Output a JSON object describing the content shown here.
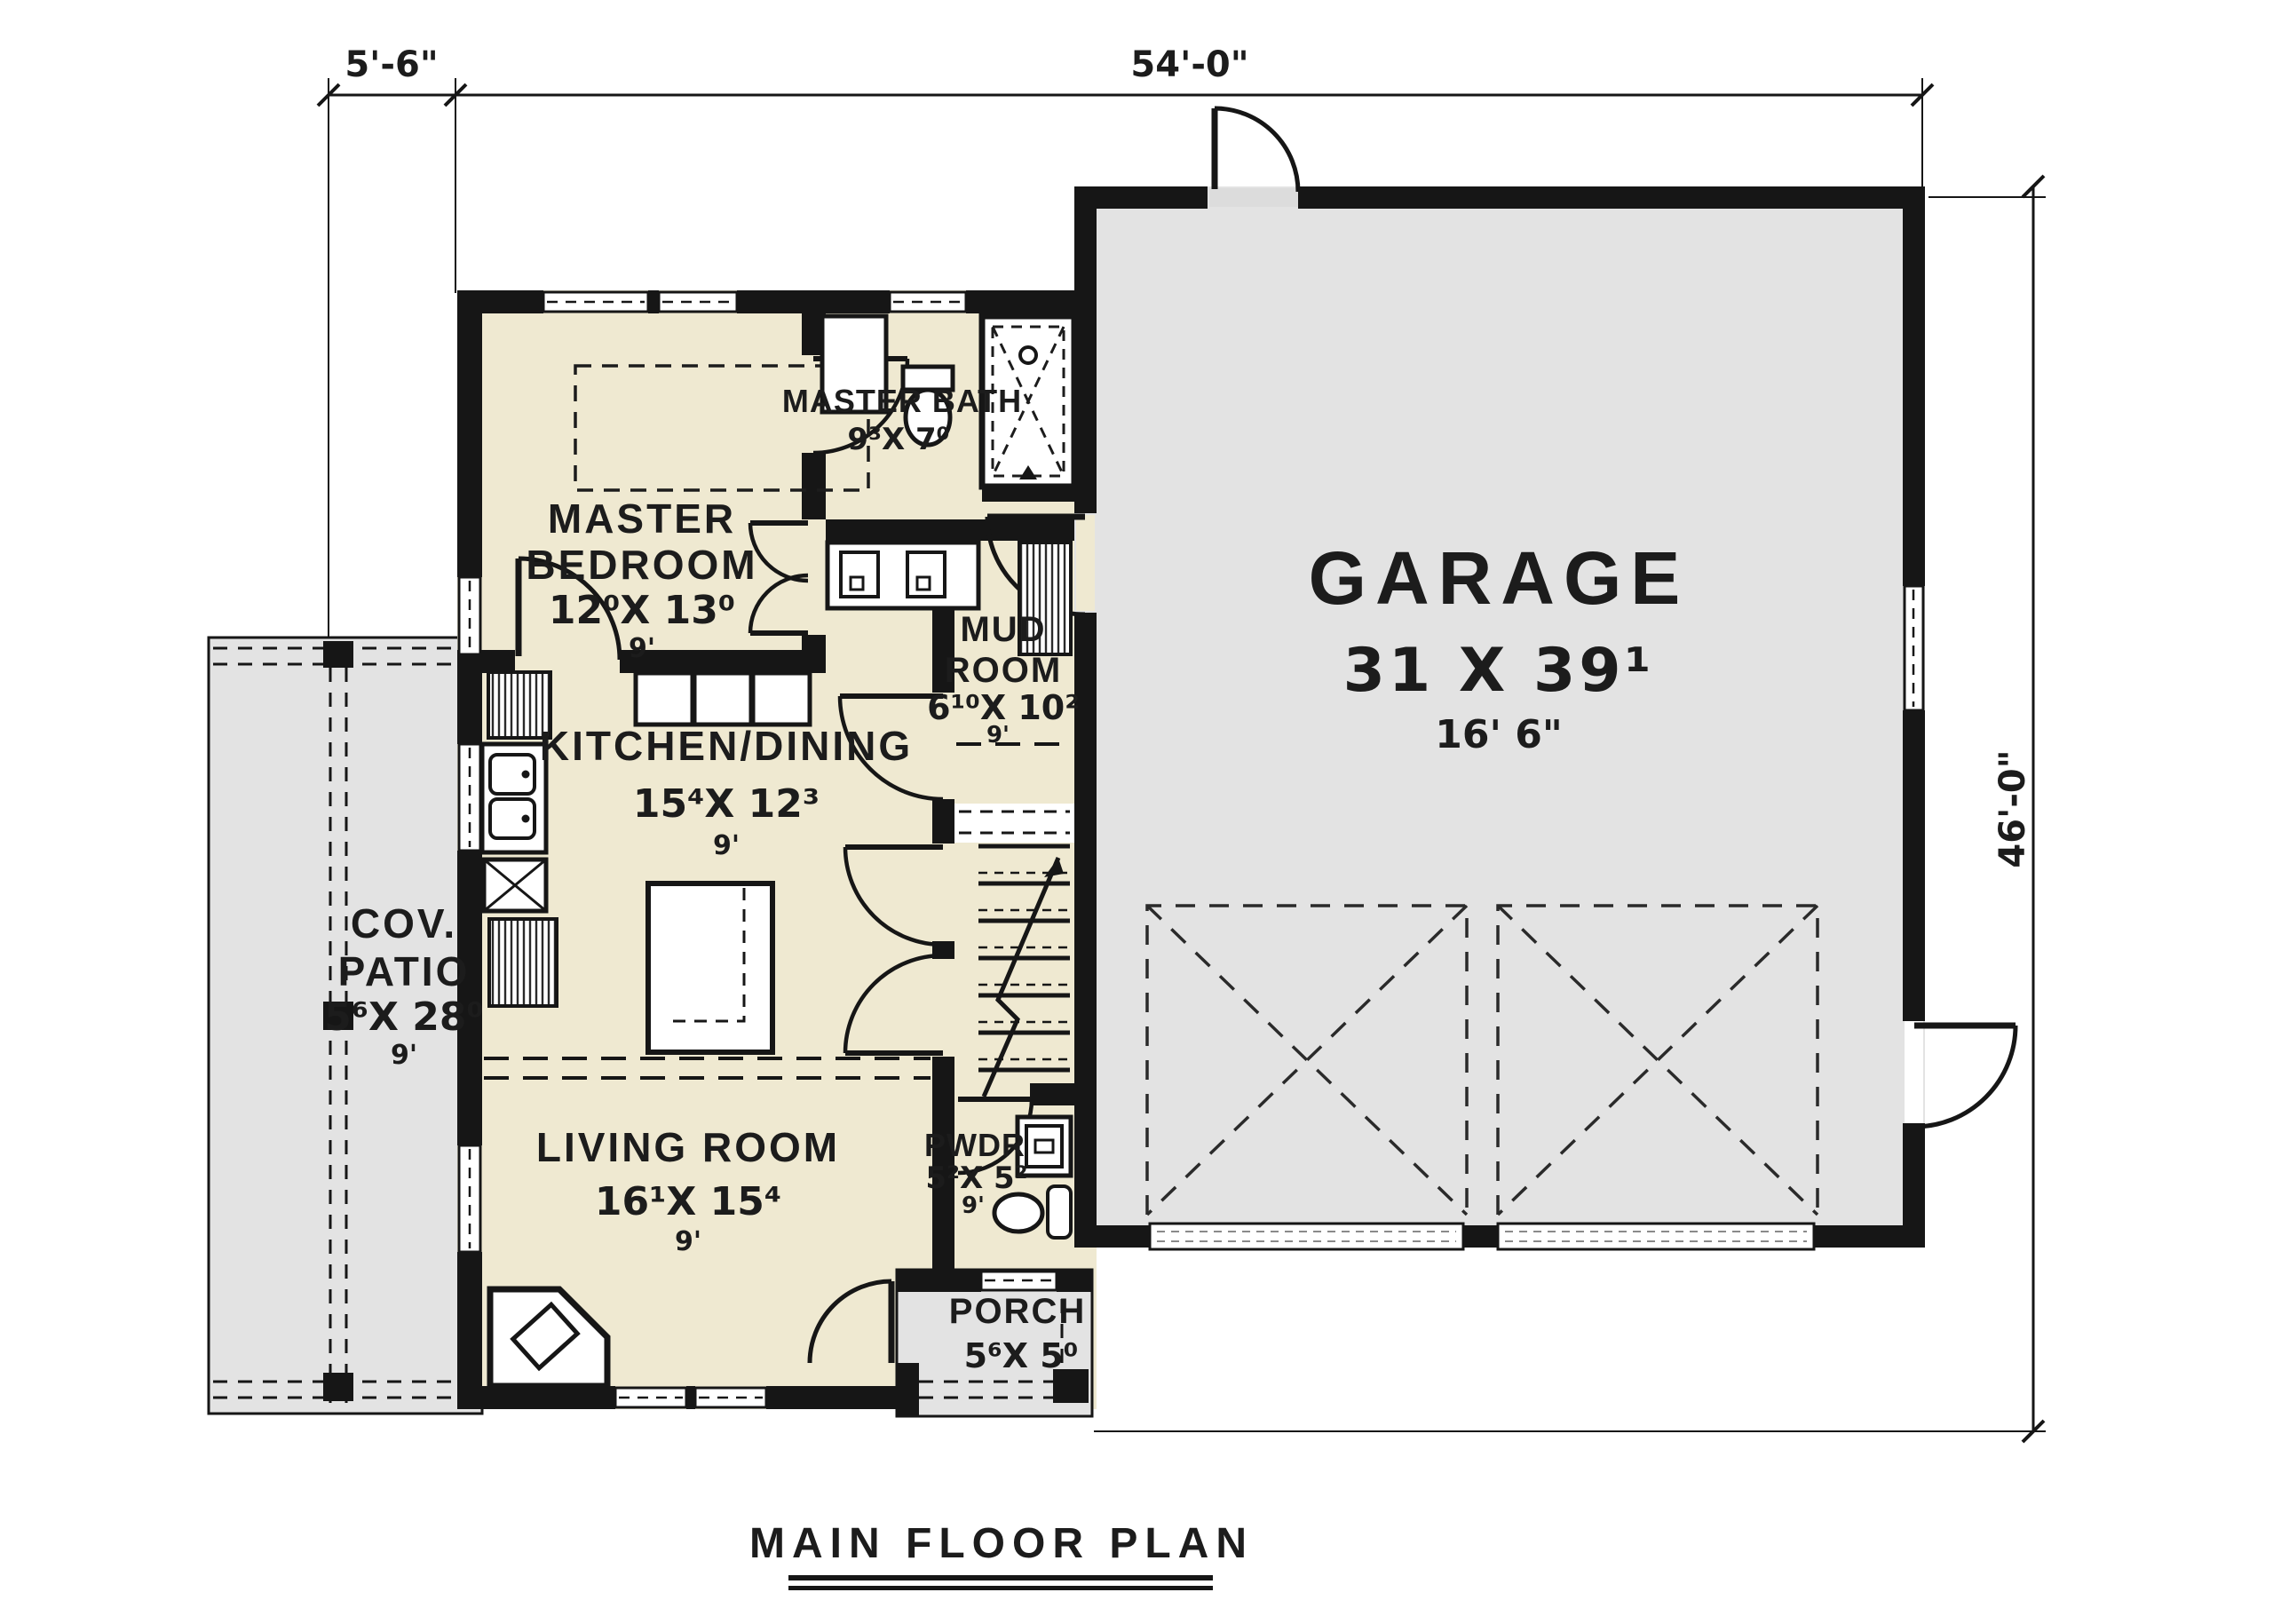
{
  "page_title": "MAIN FLOOR PLAN",
  "dimensions": {
    "left_offset": "5'-6\"",
    "overall_width": "54'-0\"",
    "overall_height": "46'-0\""
  },
  "rooms": {
    "garage": {
      "name": "GARAGE",
      "size": "31 X 39¹",
      "clg": "16' 6\""
    },
    "master_bedroom": {
      "name1": "MASTER",
      "name2": "BEDROOM",
      "size": "12⁰X 13⁰",
      "clg": "9'"
    },
    "master_bath": {
      "name": "MASTER BATH",
      "size": "9³X 7⁰"
    },
    "mud_room": {
      "name1": "MUD",
      "name2": "ROOM",
      "size": "6¹⁰X 10²",
      "clg": "9'"
    },
    "kitchen_dining": {
      "name": "KITCHEN/DINING",
      "size": "15⁴X 12³",
      "clg": "9'"
    },
    "cov_patio": {
      "name1": "COV.",
      "name2": "PATIO",
      "size": "5⁶X 28⁰",
      "clg": "9'"
    },
    "living_room": {
      "name": "LIVING ROOM",
      "size": "16¹X 15⁴",
      "clg": "9'"
    },
    "pwdr": {
      "name": "PWDR",
      "size": "5²X 5²",
      "clg": "9'"
    },
    "porch": {
      "name": "PORCH",
      "size": "5⁶X 5⁰"
    }
  },
  "colors": {
    "interior_fill": "#efe9d1",
    "exterior_space_fill": "#e3e3e3",
    "wall": "#161616",
    "background": "#ffffff"
  }
}
